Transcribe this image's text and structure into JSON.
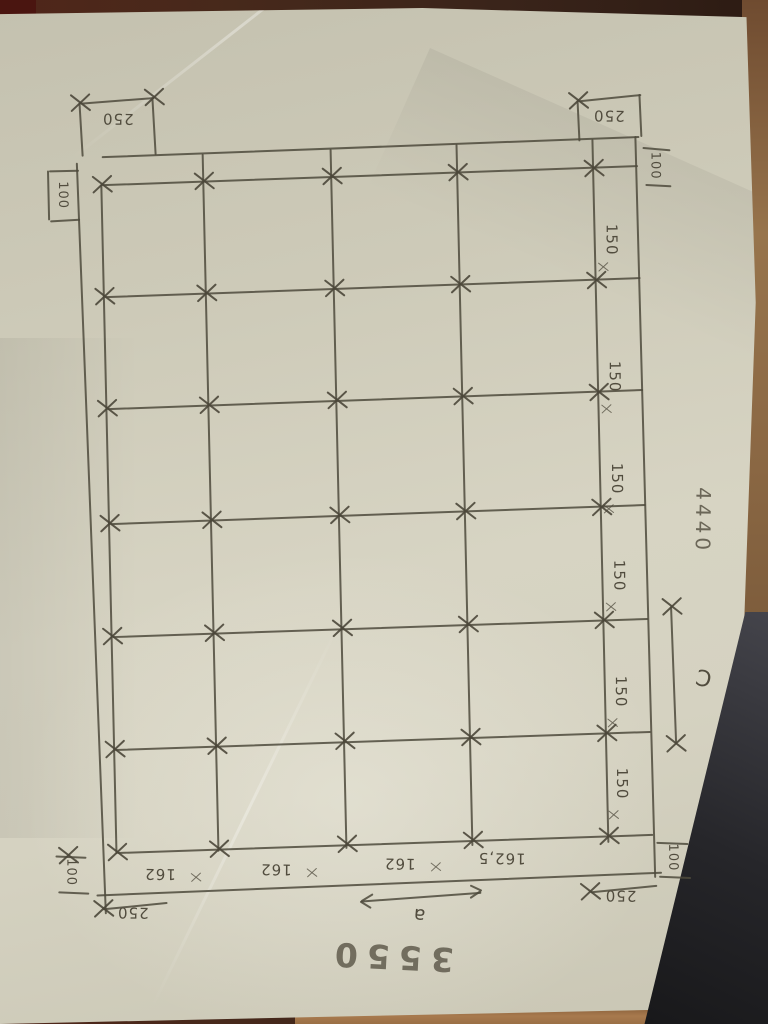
{
  "sketch": {
    "dims": {
      "tl_h": "250",
      "tl_v": "100",
      "tr_h": "250",
      "tr_v": "100",
      "bl_v": "100",
      "bl_h": "250",
      "br_v": "100",
      "br_h": "250",
      "row_spacings": [
        "150",
        "150",
        "150",
        "150",
        "150",
        "150"
      ],
      "col_spacings": [
        "162",
        "162",
        "162",
        "162,5"
      ],
      "span_label": "a",
      "span_total": "3550",
      "side_total": "4440",
      "bay_label": "C"
    },
    "colors": {
      "ink": "#4e4a3c",
      "paper": "#d2cfbe",
      "wood": "#97744c"
    }
  }
}
